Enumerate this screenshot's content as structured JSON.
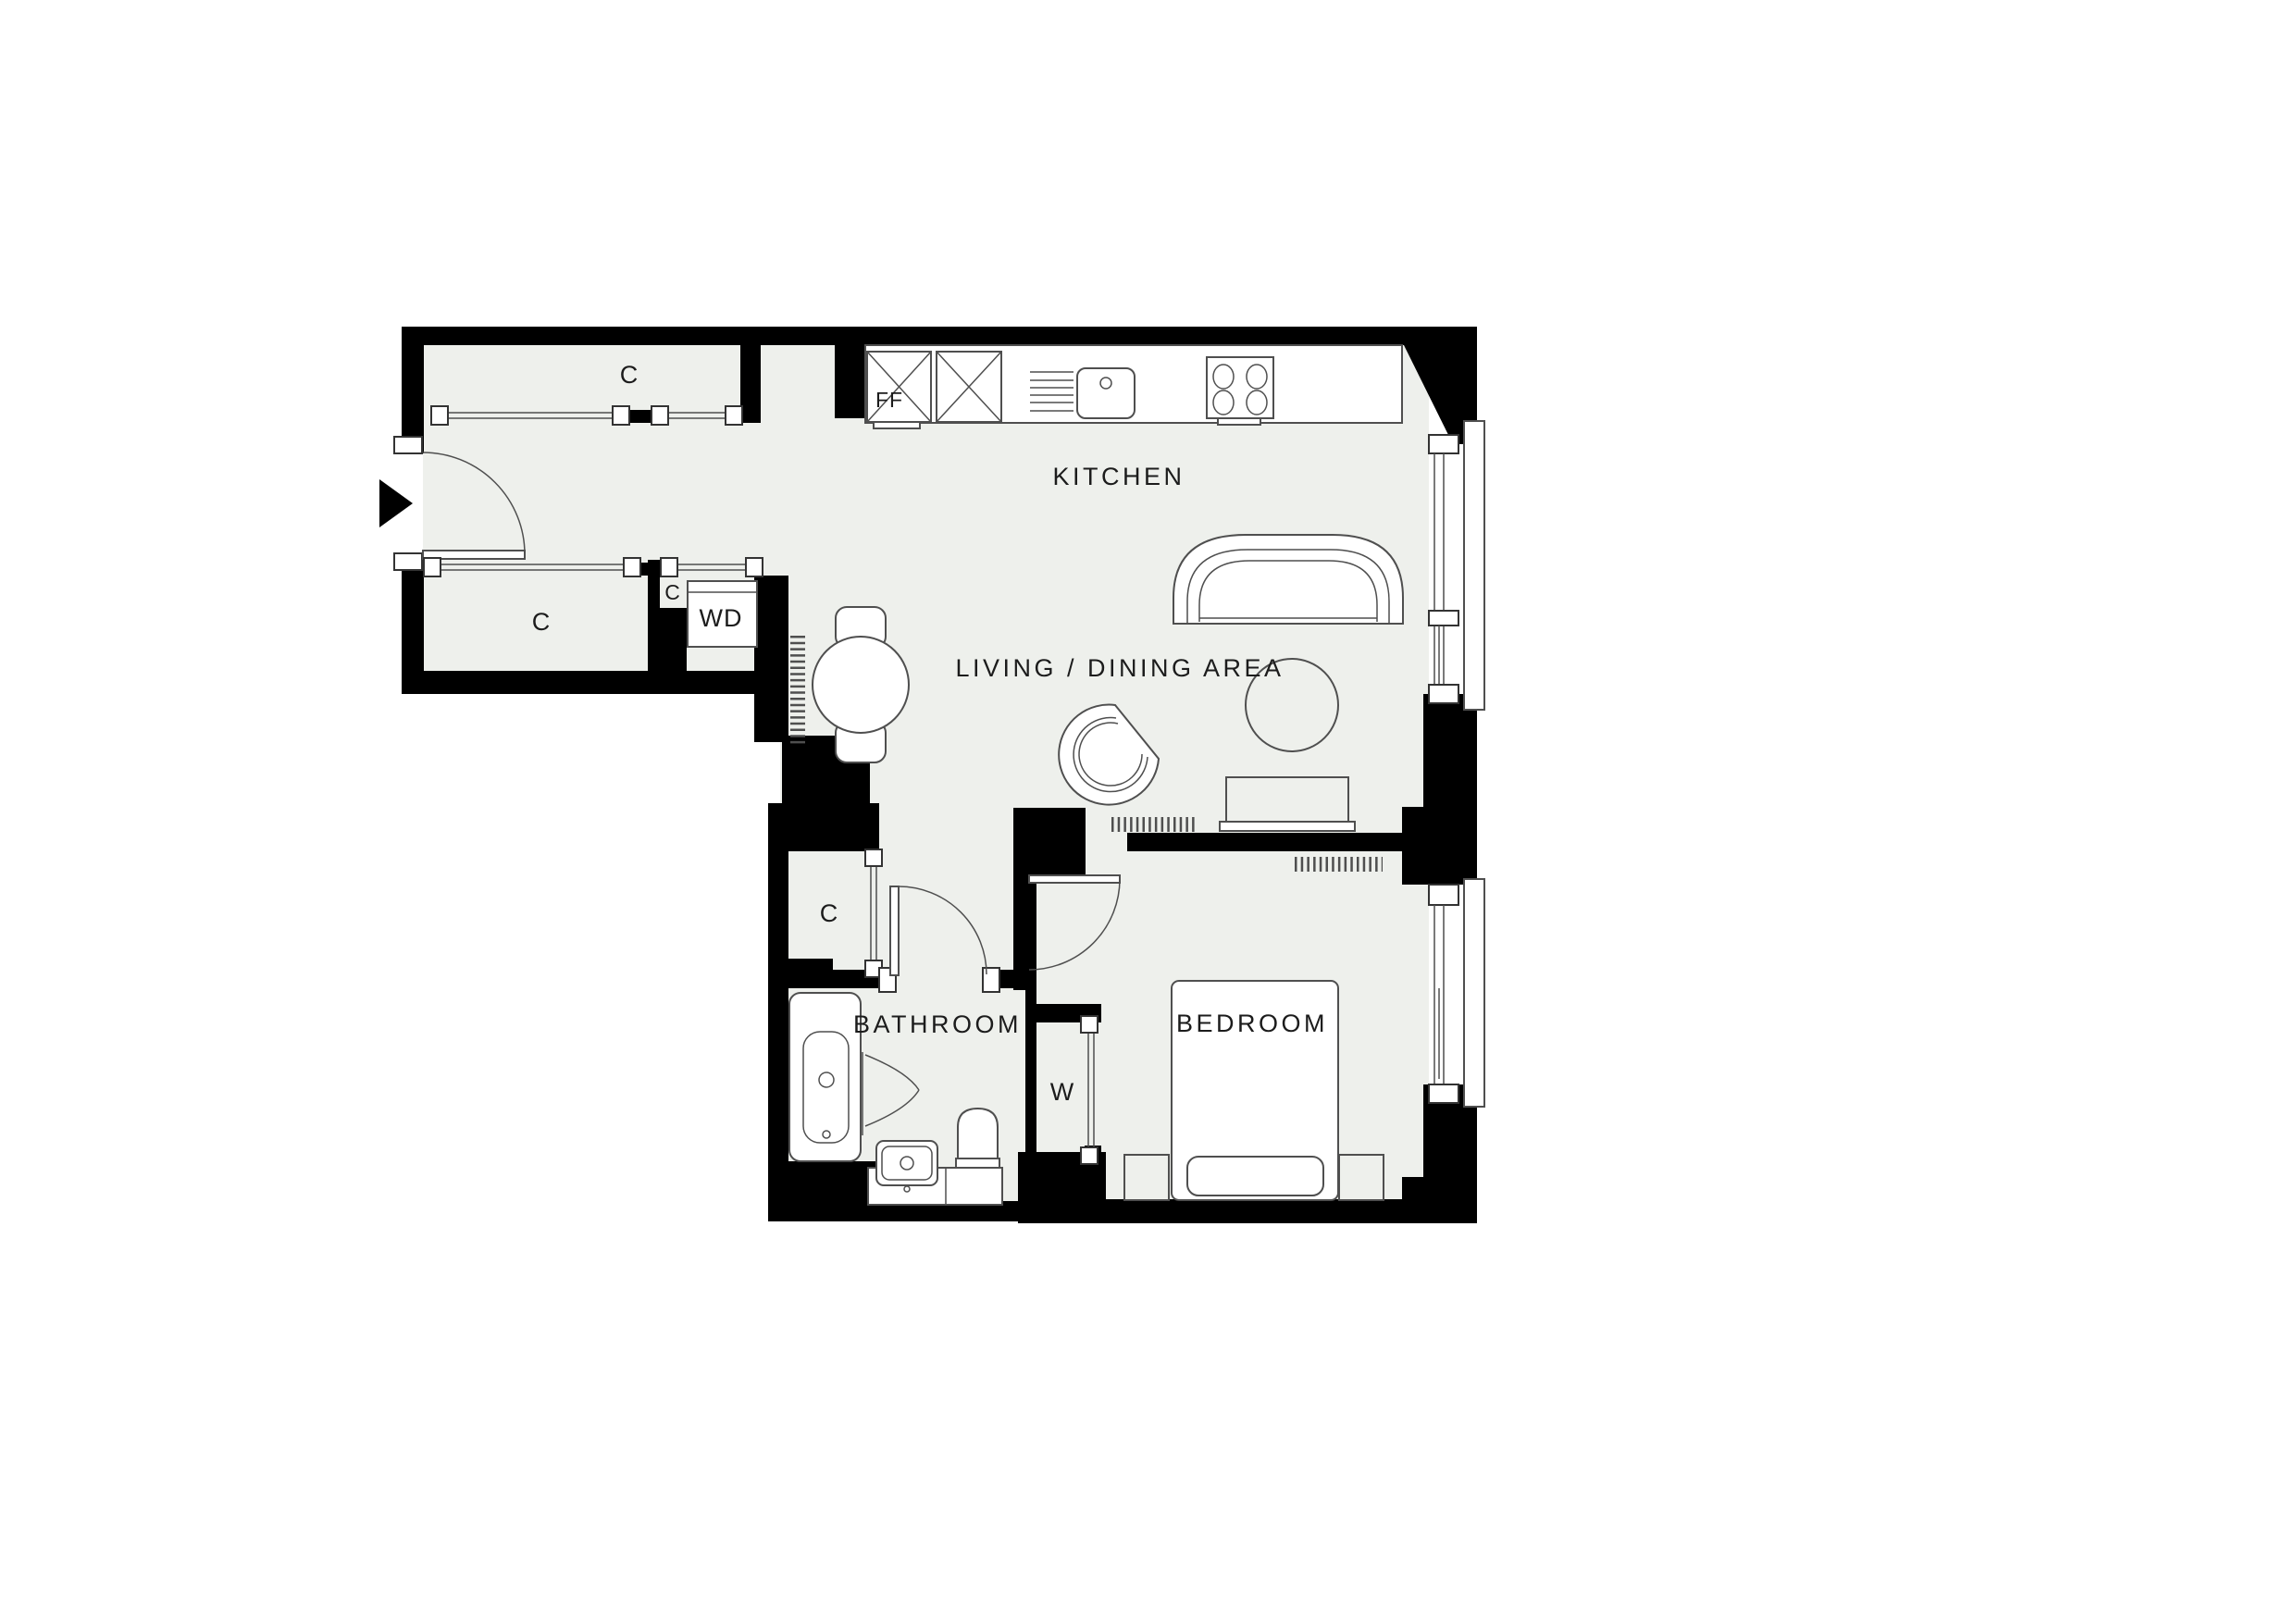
{
  "plan": {
    "rooms": {
      "kitchen": {
        "label": "KITCHEN"
      },
      "living_dining": {
        "label": "LIVING / DINING AREA"
      },
      "bedroom": {
        "label": "BEDROOM"
      },
      "bathroom": {
        "label": "BATHROOM"
      }
    },
    "closets": [
      {
        "label": "C"
      },
      {
        "label": "C"
      },
      {
        "label": "C"
      },
      {
        "label": "C"
      }
    ],
    "units": {
      "fridge_freezer": {
        "label": "FF"
      },
      "washer_dryer": {
        "label": "WD"
      },
      "wardrobe": {
        "label": "W"
      }
    },
    "icons": {
      "entry_arrow": "entry-arrow-icon"
    },
    "colors": {
      "wall": "#000000",
      "floor": "#eef0ec",
      "line": "#4f4f4f",
      "text": "#1c1c1c",
      "bg": "#ffffff"
    }
  }
}
